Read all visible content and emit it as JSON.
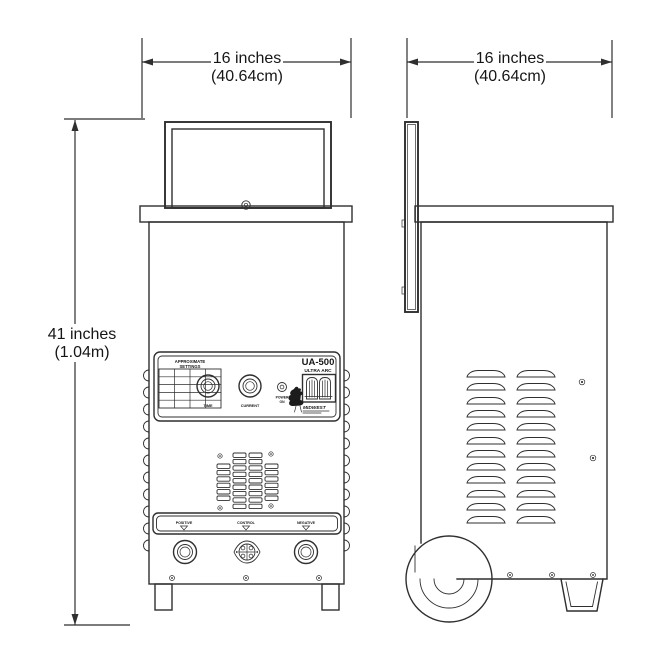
{
  "colors": {
    "ink": "#2f2f2f",
    "background": "#ffffff"
  },
  "dimensions": {
    "front_width": {
      "imperial": "16 inches",
      "metric": "(40.64cm)"
    },
    "side_width": {
      "imperial": "16 inches",
      "metric": "(40.64cm)"
    },
    "height": {
      "imperial": "41 inches",
      "metric": "(1.04m)"
    }
  },
  "front_panel": {
    "model": "UA-500",
    "model_line2": "ULTRA ARC",
    "chart_title_line1": "APPROXIMATE",
    "chart_title_line2": "SETTINGS",
    "time_knob_label": "TIME",
    "current_knob_label": "CURRENT",
    "power_label_line1": "POWER",
    "power_label_line2": "ON",
    "brand": "MIDWEST"
  },
  "terminals": {
    "positive": "POSITIVE",
    "control": "CONTROL",
    "negative": "NEGATIVE"
  }
}
